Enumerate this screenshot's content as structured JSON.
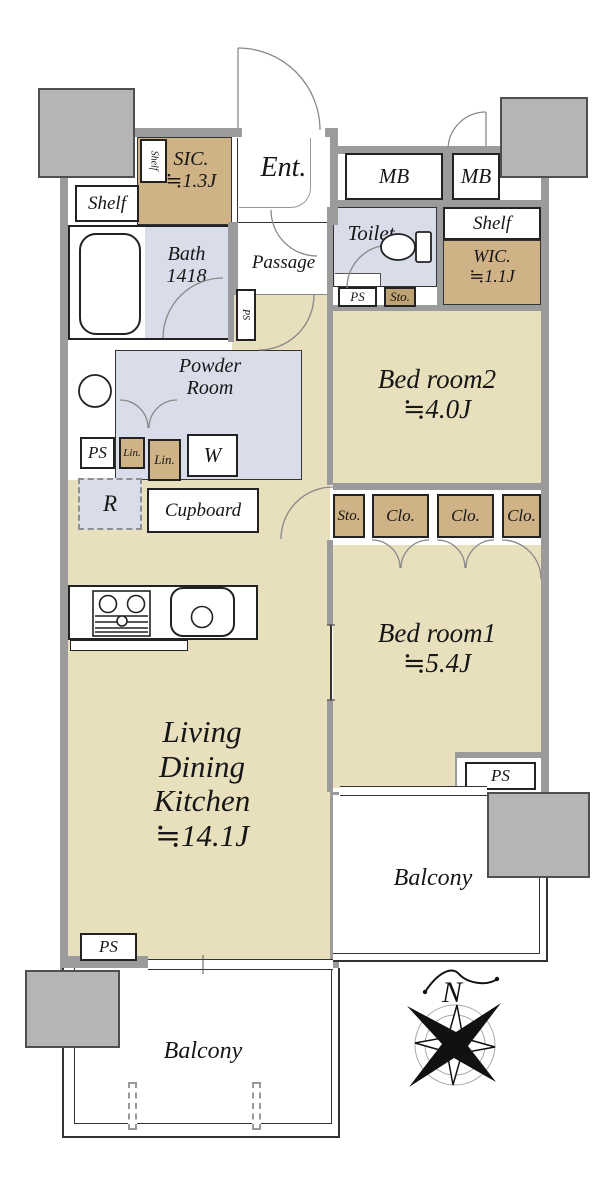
{
  "plan": {
    "entry": {
      "ent": "Ent.",
      "passage": "Passage",
      "sic_name": "SIC.",
      "sic_size": "≒1.3J",
      "shelf_vertical": "Shelf",
      "shelf_left": "Shelf",
      "ps_vertical": "PS"
    },
    "meter": {
      "mb_left": "MB",
      "mb_right": "MB"
    },
    "sanitary": {
      "toilet": "Toilet",
      "bath_name": "Bath",
      "bath_size": "1418",
      "powder_line1": "Powder",
      "powder_line2": "Room",
      "ps_entry": "PS",
      "sto_entry": "Sto.",
      "ps_powder": "PS",
      "lin_small": "Lin.",
      "lin_large": "Lin.",
      "washer": "W"
    },
    "storage": {
      "shelf_right": "Shelf",
      "wic_name": "WIC.",
      "wic_size": "≒1.1J",
      "fridge": "R",
      "cupboard": "Cupboard",
      "sto_closet": "Sto.",
      "clo_1": "Clo.",
      "clo_2": "Clo.",
      "clo_3": "Clo."
    },
    "rooms": {
      "bedroom2_name": "Bed room2",
      "bedroom2_size": "≒4.0J",
      "bedroom1_name": "Bed room1",
      "bedroom1_size": "≒5.4J",
      "ldk_line1": "Living",
      "ldk_line2": "Dining",
      "ldk_line3": "Kitchen",
      "ldk_size": "≒14.1J"
    },
    "outdoor": {
      "balcony_right": "Balcony",
      "balcony_bottom": "Balcony",
      "ps_right": "PS",
      "ps_bottom": "PS"
    },
    "compass_label": "N",
    "colors": {
      "room_beige": "#e8dfbd",
      "closet_tan": "#cfb285",
      "fixture_blue": "#d9dde9",
      "wall_gray": "#9b9b9b",
      "pillar_gray": "#b5b5b5"
    }
  }
}
